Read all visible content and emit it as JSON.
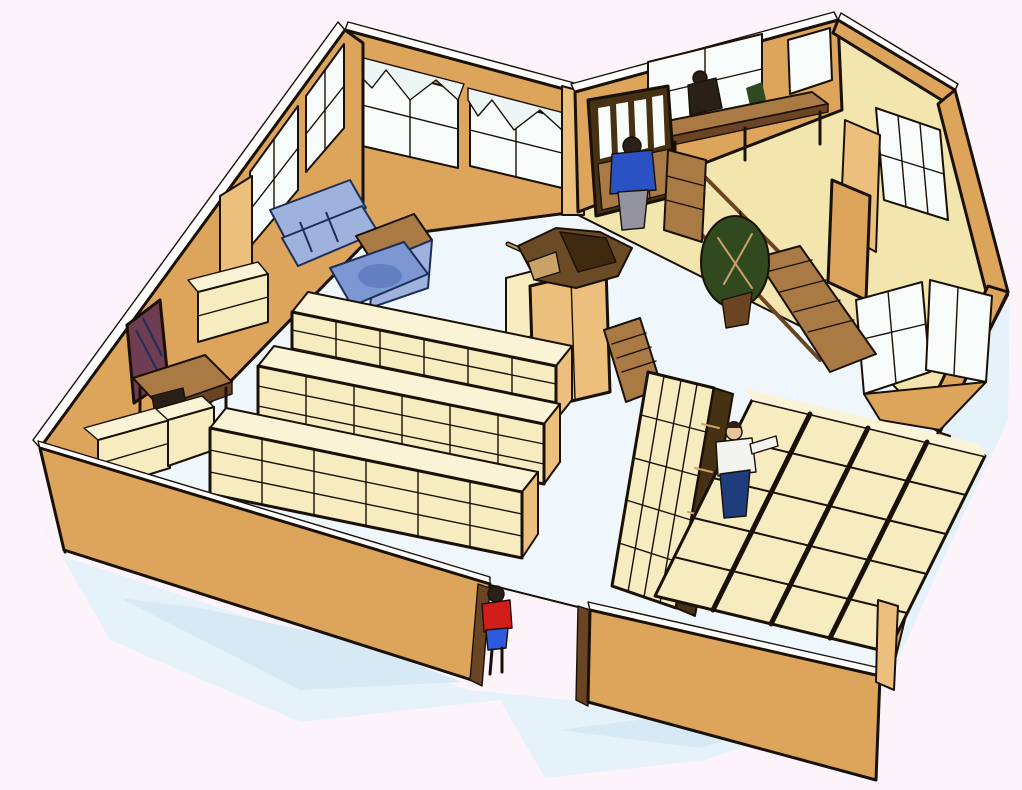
{
  "scene": {
    "description": "Isometric 3D cutaway illustration of a bookstore interior: cream shelving aisles, low display tables, a blue sofa seating corner, bay windows with curtain swags, a raised platform with stairs and railing, side rooms with windows, a central counter with a merchandise pile, an entrance doorway, and four people",
    "view": "isometric-cutaway",
    "rooms": [
      "main-sales-floor",
      "raised-platform",
      "top-right-room",
      "middle-right-room"
    ],
    "people": [
      {
        "id": "visitor-at-entrance",
        "top": "red shirt",
        "bottom": "blue shorts",
        "location": "front doorway"
      },
      {
        "id": "shopper-in-aisle",
        "top": "white shirt",
        "bottom": "navy pants",
        "location": "aisle between shelf and display tables"
      },
      {
        "id": "shopper-on-platform",
        "top": "blue jacket",
        "bottom": "gray pants",
        "location": "raised platform edge"
      },
      {
        "id": "person-at-window-desk",
        "top": "dark silhouette",
        "location": "seated at back window desk"
      }
    ],
    "objects": [
      "bookshelf-row",
      "bookshelf-row",
      "bookshelf-row",
      "wall-shelf-boxes",
      "tall-bookshelf",
      "display-table-grid",
      "central-counter",
      "merchandise-pile",
      "step-ladder",
      "display-cabinet",
      "window-desk",
      "writing-desk",
      "desk-chair",
      "sofa",
      "armchair",
      "rug",
      "wall-picture",
      "potted-plant",
      "staircase",
      "railing",
      "entrance-door-frame",
      "bay-windows",
      "curtain-swags"
    ]
  },
  "colors": {
    "bg": "#fdf4fb",
    "shadow-1": "#e6f2fa",
    "shadow-2": "#d7e9f5",
    "floor": "#eff7fc",
    "platform": "#f3e5ae",
    "wall": "#dda45c",
    "wall-light": "#ecc07c",
    "wall-dark": "#c08440",
    "cream": "#f6ecc0",
    "cream-top": "#faf3d6",
    "wood": "#a97a43",
    "wood-dark": "#6b4423",
    "cabinet": "#463112",
    "window": "#f7fbfa",
    "white": "#ffffff",
    "curtain": "#eef6f5",
    "sofa": "#9fb2dd",
    "sofa-dark": "#637fc2",
    "rug": "#7d97d2",
    "navy-outline": "#1c2f57",
    "red": "#d31d1b",
    "blue-shirt": "#2a52c5",
    "blue-shorts": "#2d5be0",
    "navy-pants": "#1e3d7c",
    "gray-pants": "#9494a0",
    "white-shirt": "#f4f4ee",
    "green": "#31491f",
    "green-dark": "#1e3012",
    "maroon": "#6f3d52",
    "maroon-dark": "#4a2536",
    "skin": "#e8c49a",
    "hair": "#2a2018",
    "merch": "#6b4a26",
    "merch-dark": "#3f2a10",
    "tan-item": "#caa36a",
    "outline": "#191006"
  }
}
